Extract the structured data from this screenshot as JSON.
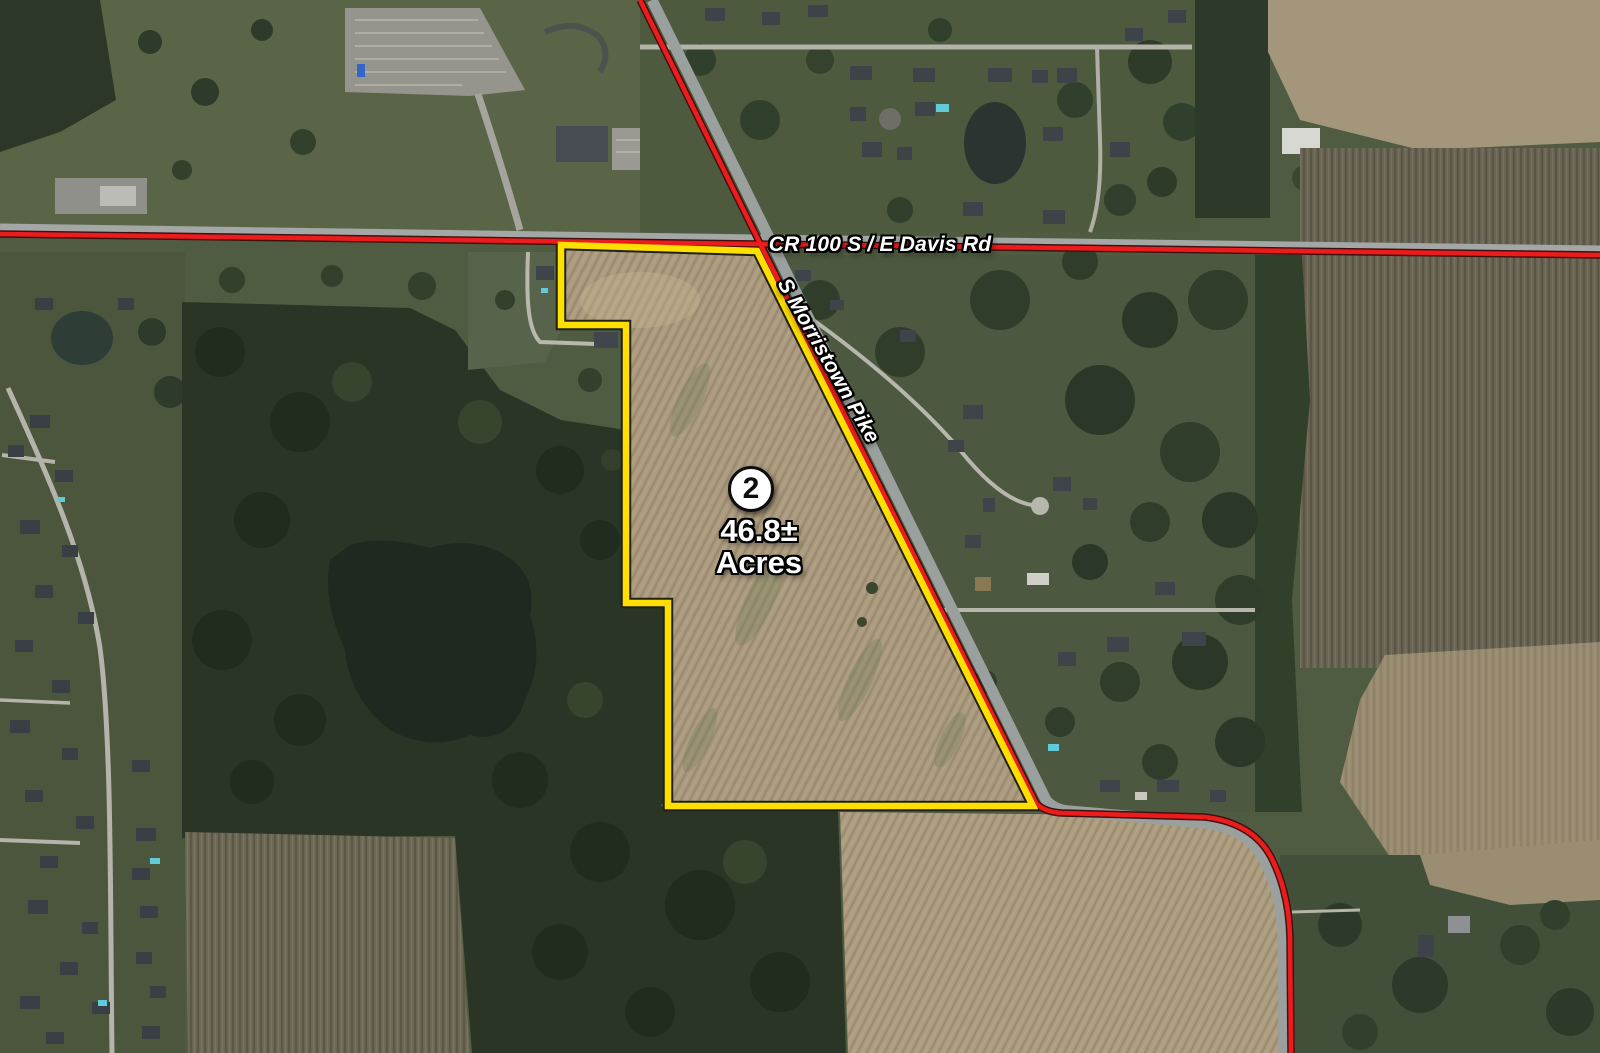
{
  "roads": {
    "primary_label": "CR 100 S / E Davis Rd",
    "secondary_label": "S Morristown Pike"
  },
  "parcel": {
    "marker_number": "2",
    "acres_value": "46.8±",
    "acres_unit": "Acres"
  },
  "colors": {
    "parcel_outline": "#ffdf00",
    "road_highlight": "#ed1c1c"
  }
}
